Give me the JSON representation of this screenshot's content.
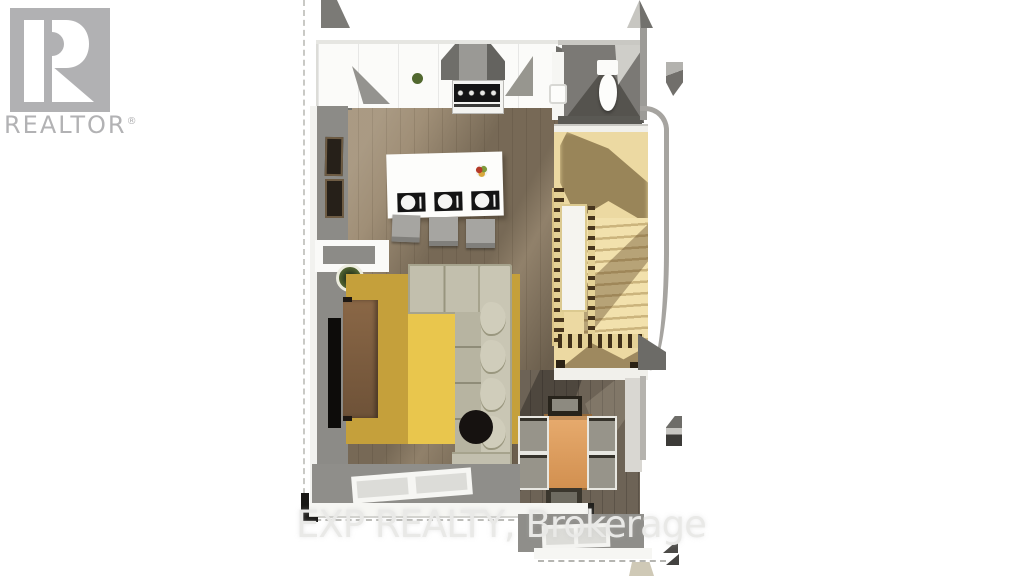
{
  "canvas": {
    "width": 1024,
    "height": 576,
    "background": "#ffffff"
  },
  "watermarks": {
    "realtor": {
      "label": "REALTOR",
      "registered_mark": "®",
      "color": "#b2b2b4"
    },
    "brokerage": {
      "text": "EXP REALTY, Brokerage",
      "color": "#e9e9e7"
    }
  },
  "floorplan": {
    "view": "top-down-3d-render",
    "rooms": [
      "kitchen",
      "living-room",
      "dining-area",
      "powder-room",
      "staircase",
      "entry"
    ],
    "furniture": [
      "kitchen-counter",
      "range-with-hood",
      "kitchen-island",
      "place-settings-x3",
      "fruit-bowl",
      "bar-stools-x3",
      "wall-frames-x2",
      "wall-tv",
      "media-console",
      "potted-plant",
      "area-rug",
      "sectional-sofa",
      "throw-pillows-x4",
      "round-ottoman",
      "toilet",
      "vanity-sink",
      "stairs-with-railing",
      "stair-landing",
      "dining-table",
      "dining-chairs-x6",
      "windows",
      "door-opening"
    ],
    "palette": {
      "wood_floor": "#a08f77",
      "wood_floor_dark": "#6d6356",
      "rug_gold": "#e9c64d",
      "rug_base": "#c5a03b",
      "sofa_fabric": "#c2bfad",
      "stairs_wood": "#ecd9a2",
      "wall_gray": "#8c8b87",
      "counter_white": "#fbfbf9",
      "table_wood": "#d29050",
      "console_wood": "#8a6746",
      "accent_black": "#151515"
    }
  }
}
